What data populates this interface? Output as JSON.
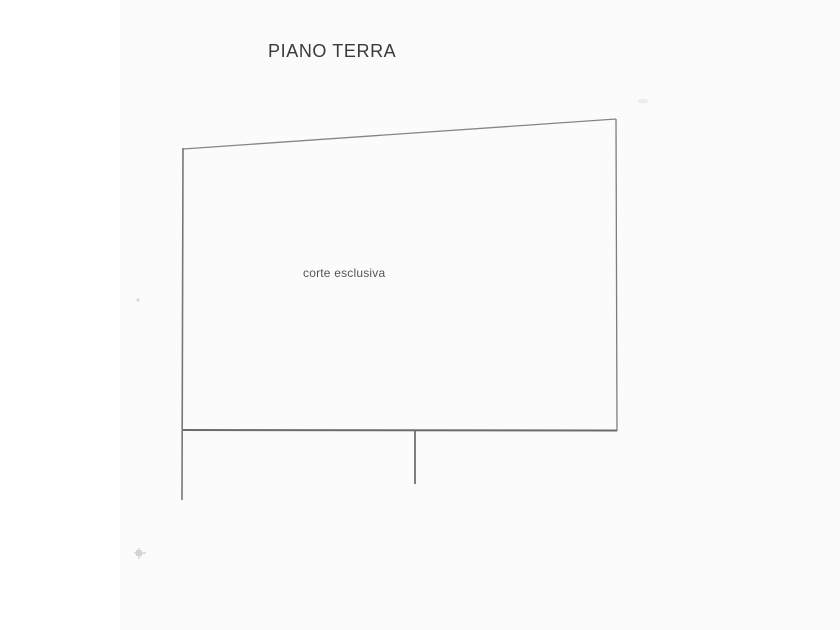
{
  "page": {
    "title": "PIANO TERRA",
    "background": "#ffffff"
  },
  "floor_plan": {
    "region_label": "corte esclusiva"
  },
  "colors": {
    "wall_line": "#7a7a7a",
    "bottom_wall_line": "#6b6b6b",
    "title_text": "#3a3a3a",
    "label_text": "#555555",
    "scan_artifact": "#c9c9c9"
  }
}
